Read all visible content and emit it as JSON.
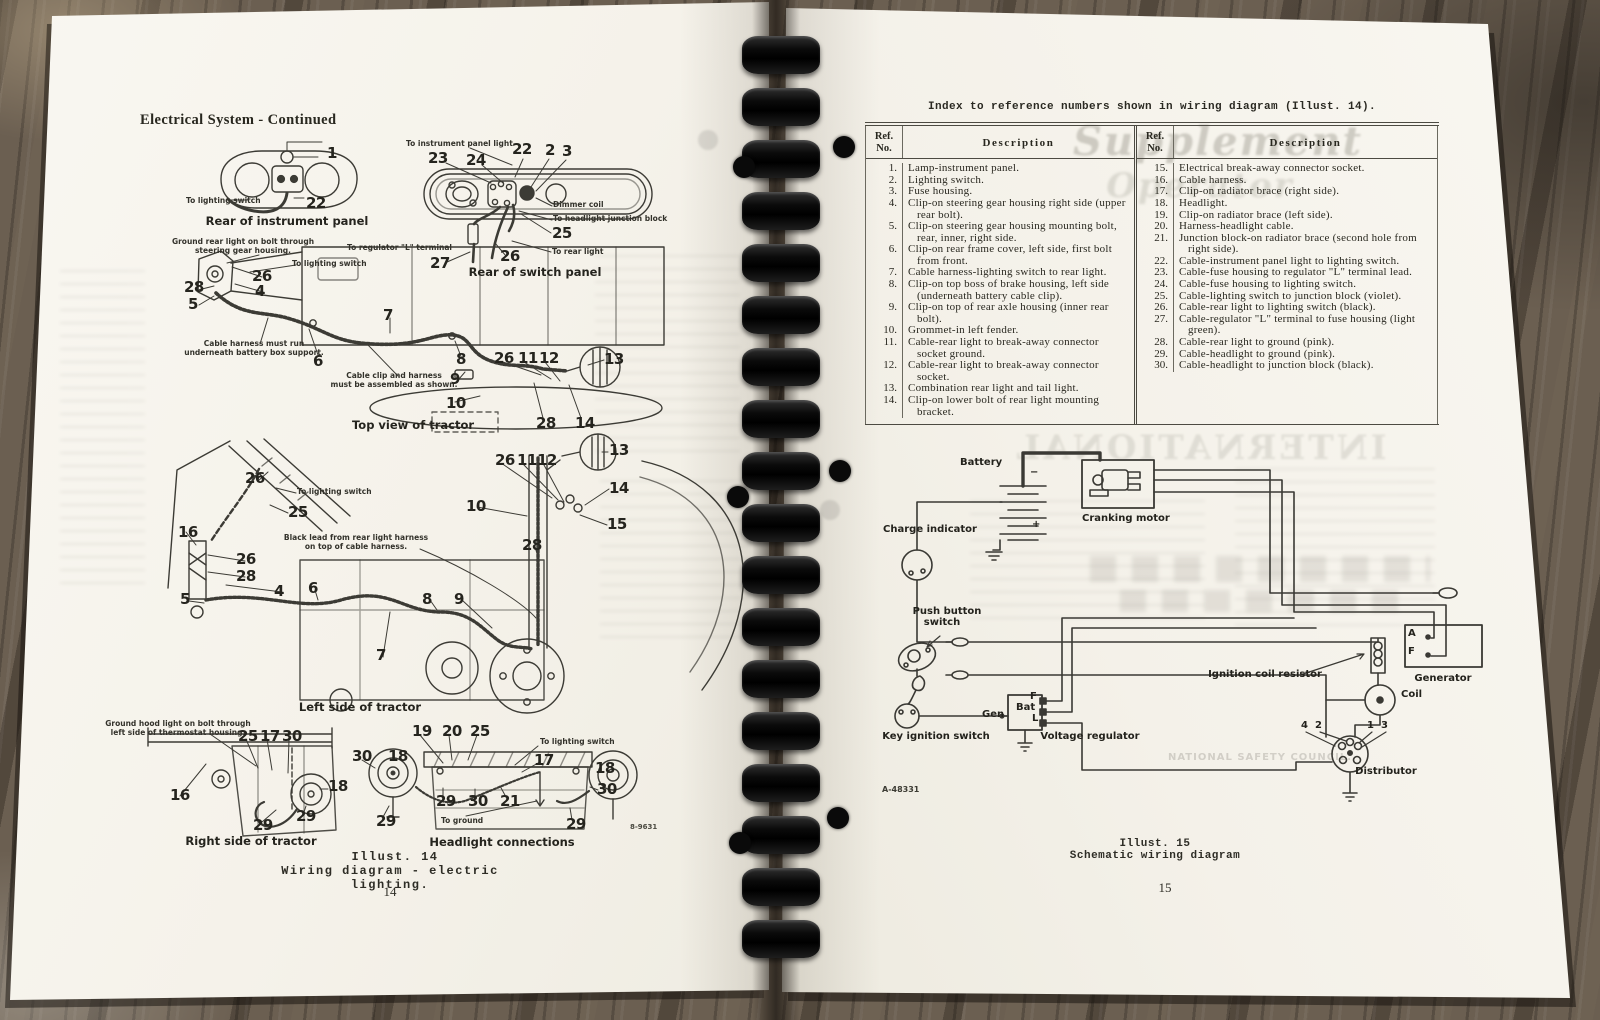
{
  "colors": {
    "paper": "#f5f2ea",
    "ink": "#28271f",
    "wood": "#6b5f51",
    "binding": "#0a0a0a",
    "rule": "#4c4a42"
  },
  "left_page": {
    "header": "Electrical System - Continued",
    "illust_caption_1": "Illust. 14",
    "illust_caption_2": "Wiring diagram - electric lighting.",
    "page_number": "14"
  },
  "right_page": {
    "index_title": "Index to reference numbers shown in wiring diagram (Illust. 14).",
    "table": {
      "ref_header_1": "Ref.",
      "ref_header_2": "No.",
      "desc_header": "Description",
      "left_rows": [
        [
          "1.",
          "Lamp-instrument panel."
        ],
        [
          "2.",
          "Lighting switch."
        ],
        [
          "3.",
          "Fuse housing."
        ],
        [
          "4.",
          "Clip-on steering gear housing right side (upper rear bolt)."
        ],
        [
          "5.",
          "Clip-on steering gear housing mounting bolt, rear, inner, right side."
        ],
        [
          "6.",
          "Clip-on rear frame cover, left side, first bolt from front."
        ],
        [
          "7.",
          "Cable harness-lighting switch to rear light."
        ],
        [
          "8.",
          "Clip-on top boss of brake housing, left side (underneath battery cable clip)."
        ],
        [
          "9.",
          "Clip-on top of rear axle housing (inner rear bolt)."
        ],
        [
          "10.",
          "Grommet-in left fender."
        ],
        [
          "11.",
          "Cable-rear light to break-away connector socket ground."
        ],
        [
          "12.",
          "Cable-rear light to break-away connector socket."
        ],
        [
          "13.",
          "Combination rear light and tail light."
        ],
        [
          "14.",
          "Clip-on lower bolt of rear light mounting bracket."
        ]
      ],
      "right_rows": [
        [
          "15.",
          "Electrical break-away connector socket."
        ],
        [
          "16.",
          "Cable harness."
        ],
        [
          "17.",
          "Clip-on radiator brace (right side)."
        ],
        [
          "18.",
          "Headlight."
        ],
        [
          "19.",
          "Clip-on radiator brace (left side)."
        ],
        [
          "20.",
          "Harness-headlight cable."
        ],
        [
          "21.",
          "Junction block-on radiator brace (second hole from right side)."
        ],
        [
          "22.",
          "Cable-instrument panel light to lighting switch."
        ],
        [
          "23.",
          "Cable-fuse housing to regulator \"L\" terminal lead."
        ],
        [
          "24.",
          "Cable-fuse housing to lighting switch."
        ],
        [
          "25.",
          "Cable-lighting switch to junction block (violet)."
        ],
        [
          "26.",
          "Cable-rear light to lighting switch (black)."
        ],
        [
          "27.",
          "Cable-regulator \"L\" terminal to fuse housing (light green)."
        ],
        [
          "28.",
          "Cable-rear light to ground (pink)."
        ],
        [
          "29.",
          "Cable-headlight to ground (pink)."
        ],
        [
          "30.",
          "Cable-headlight to junction block (black)."
        ]
      ]
    },
    "illust_caption_1": "Illust. 15",
    "illust_caption_2": "Schematic wiring diagram",
    "page_number": "15"
  },
  "labels": {
    "left-labels": [
      {
        "t": "1",
        "x": 327,
        "y": 146,
        "c": "n"
      },
      {
        "t": "To lighting switch",
        "x": 186,
        "y": 196,
        "c": "s"
      },
      {
        "t": "22",
        "x": 306,
        "y": 196,
        "c": "n"
      },
      {
        "t": "Rear of instrument panel",
        "x": 287,
        "y": 216,
        "c": "c",
        "a": "c"
      },
      {
        "t": "To instrument panel light",
        "x": 406,
        "y": 139,
        "c": "s"
      },
      {
        "t": "23",
        "x": 428,
        "y": 151,
        "c": "n"
      },
      {
        "t": "24",
        "x": 466,
        "y": 153,
        "c": "n"
      },
      {
        "t": "22",
        "x": 512,
        "y": 142,
        "c": "n"
      },
      {
        "t": "2",
        "x": 545,
        "y": 143,
        "c": "n"
      },
      {
        "t": "3",
        "x": 562,
        "y": 144,
        "c": "n"
      },
      {
        "t": "Dimmer coil",
        "x": 553,
        "y": 200,
        "c": "s"
      },
      {
        "t": "To headlight junction block",
        "x": 553,
        "y": 214,
        "c": "s"
      },
      {
        "t": "25",
        "x": 552,
        "y": 226,
        "c": "n"
      },
      {
        "t": "To regulator \"L\" terminal",
        "x": 347,
        "y": 243,
        "c": "s"
      },
      {
        "t": "27",
        "x": 430,
        "y": 256,
        "c": "n"
      },
      {
        "t": "26",
        "x": 500,
        "y": 249,
        "c": "n"
      },
      {
        "t": "To rear light",
        "x": 552,
        "y": 247,
        "c": "s"
      },
      {
        "t": "Rear of switch panel",
        "x": 535,
        "y": 267,
        "c": "c",
        "a": "c"
      },
      {
        "t": "Ground rear light on bolt through",
        "x": 243,
        "y": 237,
        "c": "s",
        "a": "c"
      },
      {
        "t": "steering gear housing.",
        "x": 243,
        "y": 246,
        "c": "s",
        "a": "c"
      },
      {
        "t": "To lighting switch",
        "x": 292,
        "y": 259,
        "c": "s"
      },
      {
        "t": "26",
        "x": 252,
        "y": 269,
        "c": "n"
      },
      {
        "t": "28",
        "x": 184,
        "y": 280,
        "c": "n"
      },
      {
        "t": "4",
        "x": 255,
        "y": 284,
        "c": "n"
      },
      {
        "t": "5",
        "x": 188,
        "y": 297,
        "c": "n"
      },
      {
        "t": "7",
        "x": 383,
        "y": 308,
        "c": "n"
      },
      {
        "t": "Cable harness must run",
        "x": 254,
        "y": 339,
        "c": "s",
        "a": "c"
      },
      {
        "t": "underneath battery box support.",
        "x": 254,
        "y": 348,
        "c": "s",
        "a": "c"
      },
      {
        "t": "6",
        "x": 313,
        "y": 354,
        "c": "n"
      },
      {
        "t": "8",
        "x": 456,
        "y": 352,
        "c": "n"
      },
      {
        "t": "Cable clip and harness",
        "x": 394,
        "y": 371,
        "c": "s",
        "a": "c"
      },
      {
        "t": "must be assembled as shown.",
        "x": 394,
        "y": 380,
        "c": "s",
        "a": "c"
      },
      {
        "t": "9",
        "x": 450,
        "y": 372,
        "c": "n"
      },
      {
        "t": "26",
        "x": 494,
        "y": 351,
        "c": "n"
      },
      {
        "t": "11",
        "x": 518,
        "y": 351,
        "c": "n"
      },
      {
        "t": "12",
        "x": 539,
        "y": 351,
        "c": "n"
      },
      {
        "t": "13",
        "x": 604,
        "y": 352,
        "c": "n"
      },
      {
        "t": "10",
        "x": 446,
        "y": 396,
        "c": "n"
      },
      {
        "t": "28",
        "x": 536,
        "y": 416,
        "c": "n"
      },
      {
        "t": "14",
        "x": 575,
        "y": 416,
        "c": "n"
      },
      {
        "t": "Top view of tractor",
        "x": 413,
        "y": 420,
        "c": "c",
        "a": "c"
      },
      {
        "t": "26",
        "x": 245,
        "y": 471,
        "c": "n"
      },
      {
        "t": "To lighting switch",
        "x": 297,
        "y": 487,
        "c": "s"
      },
      {
        "t": "25",
        "x": 288,
        "y": 505,
        "c": "n"
      },
      {
        "t": "16",
        "x": 178,
        "y": 525,
        "c": "n"
      },
      {
        "t": "Black lead from rear light harness",
        "x": 356,
        "y": 533,
        "c": "s",
        "a": "c"
      },
      {
        "t": "on top of cable harness.",
        "x": 356,
        "y": 542,
        "c": "s",
        "a": "c"
      },
      {
        "t": "26",
        "x": 236,
        "y": 552,
        "c": "n"
      },
      {
        "t": "28",
        "x": 236,
        "y": 569,
        "c": "n"
      },
      {
        "t": "4",
        "x": 274,
        "y": 584,
        "c": "n"
      },
      {
        "t": "5",
        "x": 180,
        "y": 592,
        "c": "n"
      },
      {
        "t": "6",
        "x": 308,
        "y": 581,
        "c": "n"
      },
      {
        "t": "8",
        "x": 422,
        "y": 592,
        "c": "n"
      },
      {
        "t": "9",
        "x": 454,
        "y": 592,
        "c": "n"
      },
      {
        "t": "7",
        "x": 376,
        "y": 648,
        "c": "n"
      },
      {
        "t": "10",
        "x": 466,
        "y": 499,
        "c": "n"
      },
      {
        "t": "28",
        "x": 522,
        "y": 538,
        "c": "n"
      },
      {
        "t": "26",
        "x": 495,
        "y": 453,
        "c": "n"
      },
      {
        "t": "11",
        "x": 517,
        "y": 453,
        "c": "n"
      },
      {
        "t": "12",
        "x": 537,
        "y": 453,
        "c": "n"
      },
      {
        "t": "13",
        "x": 609,
        "y": 443,
        "c": "n"
      },
      {
        "t": "14",
        "x": 609,
        "y": 481,
        "c": "n"
      },
      {
        "t": "15",
        "x": 607,
        "y": 517,
        "c": "n"
      },
      {
        "t": "Left side of tractor",
        "x": 360,
        "y": 702,
        "c": "c",
        "a": "c"
      },
      {
        "t": "Ground hood light on bolt through",
        "x": 178,
        "y": 719,
        "c": "s",
        "a": "c"
      },
      {
        "t": "left side of thermostat housing.",
        "x": 178,
        "y": 728,
        "c": "s",
        "a": "c"
      },
      {
        "t": "25",
        "x": 238,
        "y": 729,
        "c": "n"
      },
      {
        "t": "17",
        "x": 260,
        "y": 729,
        "c": "n"
      },
      {
        "t": "30",
        "x": 282,
        "y": 729,
        "c": "n"
      },
      {
        "t": "16",
        "x": 170,
        "y": 788,
        "c": "n"
      },
      {
        "t": "18",
        "x": 328,
        "y": 779,
        "c": "n"
      },
      {
        "t": "29",
        "x": 253,
        "y": 818,
        "c": "n"
      },
      {
        "t": "29",
        "x": 296,
        "y": 809,
        "c": "n"
      },
      {
        "t": "Right side of tractor",
        "x": 251,
        "y": 836,
        "c": "c",
        "a": "c"
      },
      {
        "t": "30",
        "x": 352,
        "y": 749,
        "c": "n"
      },
      {
        "t": "18",
        "x": 388,
        "y": 749,
        "c": "n"
      },
      {
        "t": "19",
        "x": 412,
        "y": 724,
        "c": "n"
      },
      {
        "t": "20",
        "x": 442,
        "y": 724,
        "c": "n"
      },
      {
        "t": "25",
        "x": 470,
        "y": 724,
        "c": "n"
      },
      {
        "t": "To lighting switch",
        "x": 540,
        "y": 737,
        "c": "s"
      },
      {
        "t": "17",
        "x": 534,
        "y": 753,
        "c": "n"
      },
      {
        "t": "18",
        "x": 595,
        "y": 761,
        "c": "n"
      },
      {
        "t": "30",
        "x": 597,
        "y": 782,
        "c": "n"
      },
      {
        "t": "29",
        "x": 436,
        "y": 794,
        "c": "n"
      },
      {
        "t": "30",
        "x": 468,
        "y": 794,
        "c": "n"
      },
      {
        "t": "21",
        "x": 500,
        "y": 794,
        "c": "n"
      },
      {
        "t": "29",
        "x": 376,
        "y": 814,
        "c": "n"
      },
      {
        "t": "To ground",
        "x": 441,
        "y": 816,
        "c": "s"
      },
      {
        "t": "29",
        "x": 566,
        "y": 817,
        "c": "n"
      },
      {
        "t": "Headlight connections",
        "x": 502,
        "y": 837,
        "c": "c",
        "a": "c"
      },
      {
        "t": "8-9631",
        "x": 630,
        "y": 824,
        "c": "tiny",
        "n": "figure-code-left"
      }
    ],
    "right-labels": [
      {
        "t": "Battery",
        "x": 190,
        "y": 457,
        "c": "b",
        "n": "battery-label"
      },
      {
        "t": "−",
        "x": 260,
        "y": 468,
        "c": "bs"
      },
      {
        "t": "+",
        "x": 262,
        "y": 520,
        "c": "bs"
      },
      {
        "t": "Cranking motor",
        "x": 312,
        "y": 513,
        "c": "b",
        "n": "cranking-motor-label"
      },
      {
        "t": "Charge indicator",
        "x": 160,
        "y": 524,
        "c": "b",
        "a": "c",
        "n": "charge-indicator-label"
      },
      {
        "t": "Push button",
        "x": 177,
        "y": 606,
        "c": "b",
        "a": "c",
        "n": "push-button-switch-label"
      },
      {
        "t": "switch",
        "x": 172,
        "y": 617,
        "c": "b",
        "a": "c"
      },
      {
        "t": "Key ignition switch",
        "x": 166,
        "y": 731,
        "c": "b",
        "a": "c",
        "n": "key-ignition-switch-label"
      },
      {
        "t": "Gen",
        "x": 212,
        "y": 710,
        "c": "bs"
      },
      {
        "t": "F",
        "x": 260,
        "y": 692,
        "c": "bs"
      },
      {
        "t": "Bat",
        "x": 246,
        "y": 703,
        "c": "bs"
      },
      {
        "t": "L",
        "x": 262,
        "y": 714,
        "c": "bs"
      },
      {
        "t": "Voltage regulator",
        "x": 320,
        "y": 731,
        "c": "b",
        "a": "c",
        "n": "voltage-regulator-label"
      },
      {
        "t": "Ignition coil resistor",
        "x": 495,
        "y": 669,
        "c": "b",
        "a": "c",
        "n": "ignition-coil-resistor-label"
      },
      {
        "t": "Generator",
        "x": 673,
        "y": 673,
        "c": "b",
        "a": "c",
        "n": "generator-label"
      },
      {
        "t": "A",
        "x": 638,
        "y": 629,
        "c": "bs"
      },
      {
        "t": "F",
        "x": 638,
        "y": 647,
        "c": "bs"
      },
      {
        "t": "Coil",
        "x": 631,
        "y": 689,
        "c": "b",
        "n": "coil-label"
      },
      {
        "t": "Distributor",
        "x": 616,
        "y": 766,
        "c": "b",
        "a": "c",
        "n": "distributor-label"
      },
      {
        "t": "4",
        "x": 531,
        "y": 721,
        "c": "bs"
      },
      {
        "t": "2",
        "x": 545,
        "y": 721,
        "c": "bs"
      },
      {
        "t": "1",
        "x": 597,
        "y": 721,
        "c": "bs"
      },
      {
        "t": "3",
        "x": 611,
        "y": 721,
        "c": "bs"
      },
      {
        "t": "A-48331",
        "x": 112,
        "y": 786,
        "c": "code",
        "n": "figure-code-right"
      }
    ],
    "right-ghost": [
      {
        "t": "Supplement",
        "x": 448,
        "y": 118,
        "c": "g1",
        "a": "c",
        "n": "bleed-through-text"
      },
      {
        "t": "Operator",
        "x": 430,
        "y": 166,
        "c": "g2",
        "a": "c",
        "n": "bleed-through-text"
      },
      {
        "t": "INTERNATIONAL",
        "x": 430,
        "y": 428,
        "c": "g3",
        "a": "c",
        "n": "bleed-through-text"
      },
      {
        "t": "NATIONAL SAFETY COUNCIL.",
        "x": 490,
        "y": 752,
        "c": "g4",
        "a": "c",
        "n": "bleed-through-text"
      }
    ]
  }
}
